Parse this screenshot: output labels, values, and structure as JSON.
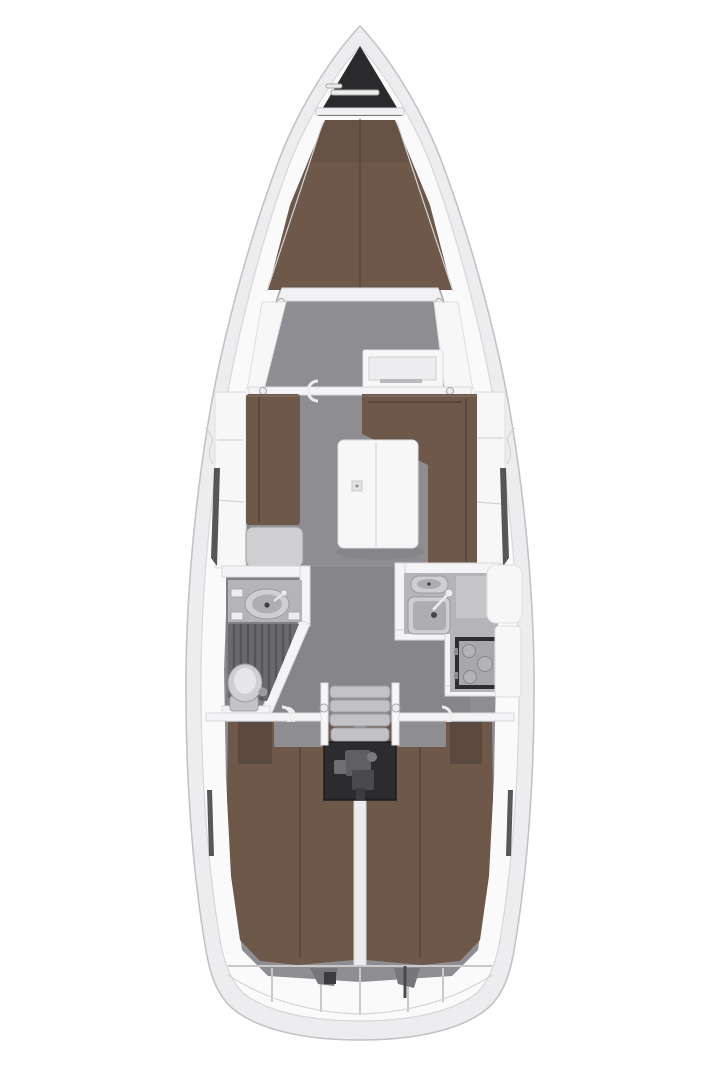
{
  "title": "Sailing yacht interior layout plan, top view",
  "colors": {
    "page_bg": "#ffffff",
    "hull_shell": "#ededef",
    "hull_edge": "#c3c3c6",
    "deck": "#fafafb",
    "deck_edge": "#d7d7da",
    "floor": "#8e8e92",
    "floor_dark": "#7f7f84",
    "cushion": "#6d584a",
    "cushion_dark": "#5b4940",
    "cushion_seam": "#54433a",
    "locker_dark": "#2a2a2c",
    "engine_dark": "#2c2c2e",
    "fixture_light": "#cfcfd2",
    "fixture_inner": "#aeaeb2",
    "fixture_mid": "#b5b5b9",
    "wall_white": "#f4f4f6",
    "wall_edge": "#d9d9dc",
    "white_panel": "#f7f7f8",
    "grate": "#6a6a6e",
    "grate_line": "#55555a",
    "metal": "#a8a8ac"
  },
  "regions": {
    "plan": "Sailing yacht interior layout plan, top view",
    "hull": "Hull and side decks",
    "anchor_locker": "Bow anchor locker",
    "v_berth": "Forward cabin V-berth",
    "forward_cabin": "Forward cabin",
    "saloon": "Saloon",
    "port_settee": "Port settee",
    "chart_table": "Chart table",
    "l_settee": "Starboard L-shaped settee",
    "saloon_table": "Saloon folding table",
    "head": "Head compartment with shower",
    "sink_head": "Head washbasin",
    "shower_grate": "Shower floor grate",
    "toilet": "Marine toilet",
    "galley": "Galley",
    "galley_sinks": "Galley double sink",
    "stove": "Gimballed stove",
    "companionway": "Companionway ladder",
    "engine": "Engine compartment",
    "aft_cabin_port": "Port aft double berth",
    "aft_cabin_stbd": "Starboard aft double berth",
    "transom": "Transom lockers"
  }
}
